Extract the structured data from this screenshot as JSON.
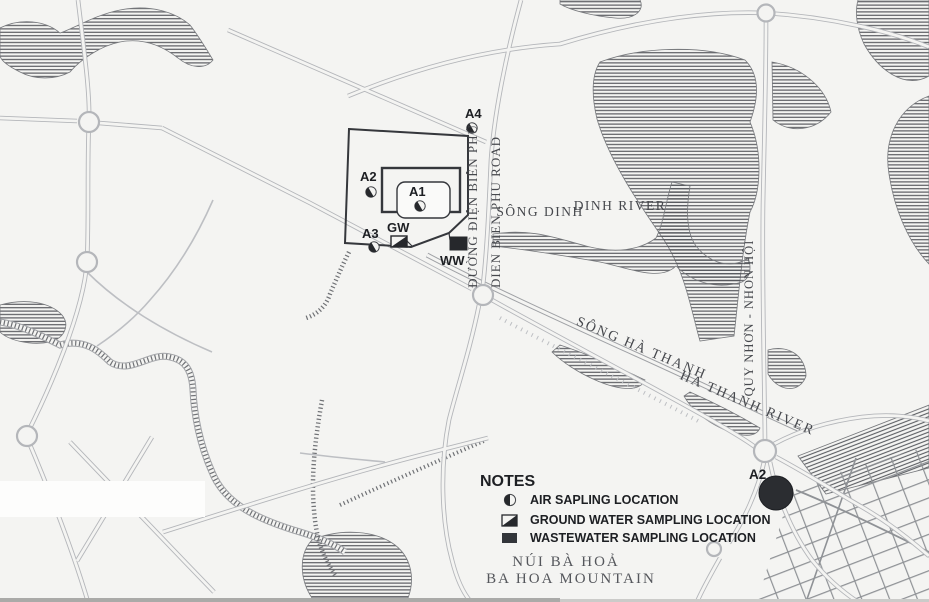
{
  "map": {
    "site_markers": {
      "a1": {
        "label": "A1",
        "type": "air-sampling"
      },
      "a2": {
        "label": "A2",
        "type": "air-sampling"
      },
      "a3": {
        "label": "A3",
        "type": "air-sampling"
      },
      "a4": {
        "label": "A4",
        "type": "air-sampling"
      },
      "gw": {
        "label": "GW",
        "type": "ground-water-sampling"
      },
      "ww": {
        "label": "WW",
        "type": "wastewater-sampling"
      },
      "a2_city": {
        "label": "A2",
        "type": "air-sampling-large"
      }
    },
    "place_labels": {
      "road_vi": "ĐƯỜNG ĐIỆN BIÊN PHỦ",
      "road_en": "DIEN BIEN PHU ROAD",
      "song_dinh": "SÔNG DINH",
      "dinh_river": "DINH RIVER",
      "song_ha_thanh": "SÔNG HÀ THANH",
      "ha_thanh_river": "HA THANH RIVER",
      "quy_nhon_nhon_hoi": "QUY NHƠN - NHON HỘI",
      "mountain_vi": "NÚI BÀ HOẢ",
      "mountain_en": "BA HOA MOUNTAIN"
    },
    "legend": {
      "title": "NOTES",
      "items": [
        {
          "icon": "air-sampling-icon",
          "label": "AIR SAPLING LOCATION"
        },
        {
          "icon": "ground-water-sampling-icon",
          "label": "GROUND WATER SAMPLING LOCATION"
        },
        {
          "icon": "wastewater-sampling-icon",
          "label": "WASTEWATER SAMPLING LOCATION"
        }
      ]
    },
    "colors": {
      "paper": "#f4f4f2",
      "ink": "#1d1f23",
      "serif_label": "#46484d",
      "road": "#b4b6ba",
      "hatch": "#53555a",
      "marker_fill": "#26282c"
    }
  }
}
